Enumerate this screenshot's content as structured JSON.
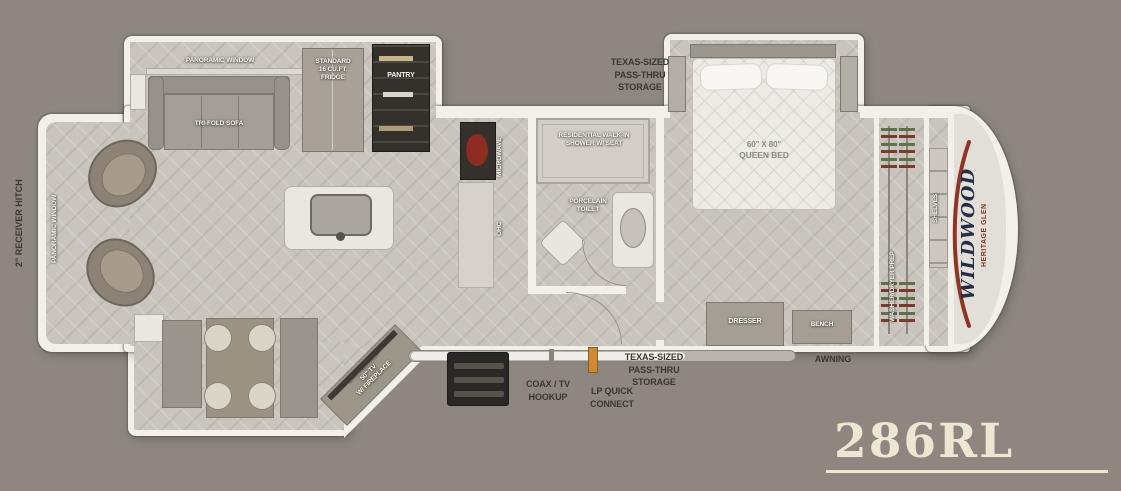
{
  "model": "286RL",
  "colors": {
    "background": "#8d8780",
    "wall": "#f3f0ea",
    "accent_red": "#8e3424",
    "logo_navy": "#262e47",
    "cream": "#ece6d3",
    "lp_orange": "#cf8a33",
    "range_red": "#8d2c20"
  },
  "brand": {
    "name": "WILDWOOD",
    "series": "HERITAGE GLEN"
  },
  "exterior": {
    "hitch": "2\" RECEIVER HITCH",
    "awning": "AWNING",
    "storage_top": [
      "TEXAS-SIZED",
      "PASS-THRU",
      "STORAGE"
    ],
    "storage_bottom": [
      "TEXAS-SIZED",
      "PASS-THRU",
      "STORAGE"
    ],
    "coax": [
      "COAX / TV",
      "HOOKUP"
    ],
    "lp": [
      "LP QUICK",
      "CONNECT"
    ]
  },
  "living": {
    "panoramic_window_top": "PANORAMIC WINDOW",
    "panoramic_window_side": "PANORAMIC WINDOW",
    "sofa": "TRI-FOLD SOFA",
    "fridge": [
      "STANDARD",
      "16 CU.FT.",
      "FRIDGE"
    ],
    "pantry": "PANTRY",
    "ent_center": [
      "ENT. CENTER",
      "50\" TV",
      "W/ FIREPLACE"
    ]
  },
  "kitchen": {
    "microwave": "MICROWAVE",
    "ohc": "OHC"
  },
  "bath": {
    "shower": [
      "RESIDENTIAL WALK-IN",
      "SHOWER W/ SEAT"
    ],
    "toilet": [
      "PORCELAIN",
      "TOILET"
    ]
  },
  "bedroom": {
    "bed": [
      "60\" X 80\"",
      "QUEEN BED"
    ],
    "dresser": "DRESSER",
    "bench": "BENCH",
    "wardrobe": "WASHER/DRYER PREP",
    "shelves": "SHELVES"
  }
}
